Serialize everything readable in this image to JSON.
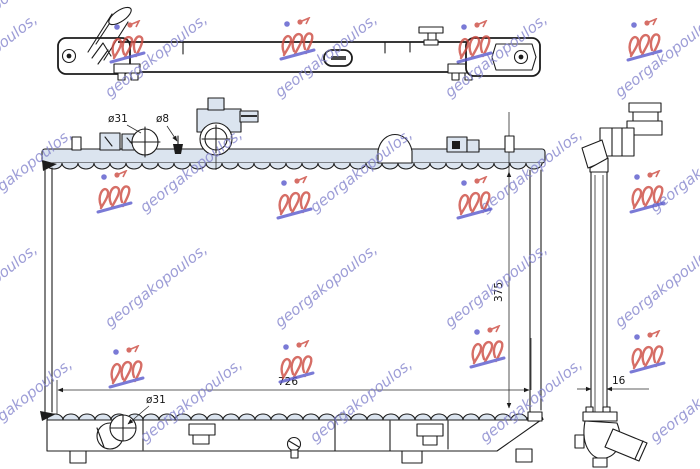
{
  "watermark": {
    "text": "georgakopoulos,",
    "text_color": "#8282cc",
    "logo_red": "#cd4a40",
    "logo_blue": "#5a5acc"
  },
  "drawing": {
    "tank_fill_color": "#dbe4ef",
    "line_color": "#1c1c1c",
    "dimensions": {
      "top_inlet_diameter": "ø31",
      "overflow_fitting_diameter": "ø8",
      "core_height": "375",
      "core_width": "726",
      "bottom_outlet_diameter": "ø31",
      "core_thickness": "16"
    }
  }
}
